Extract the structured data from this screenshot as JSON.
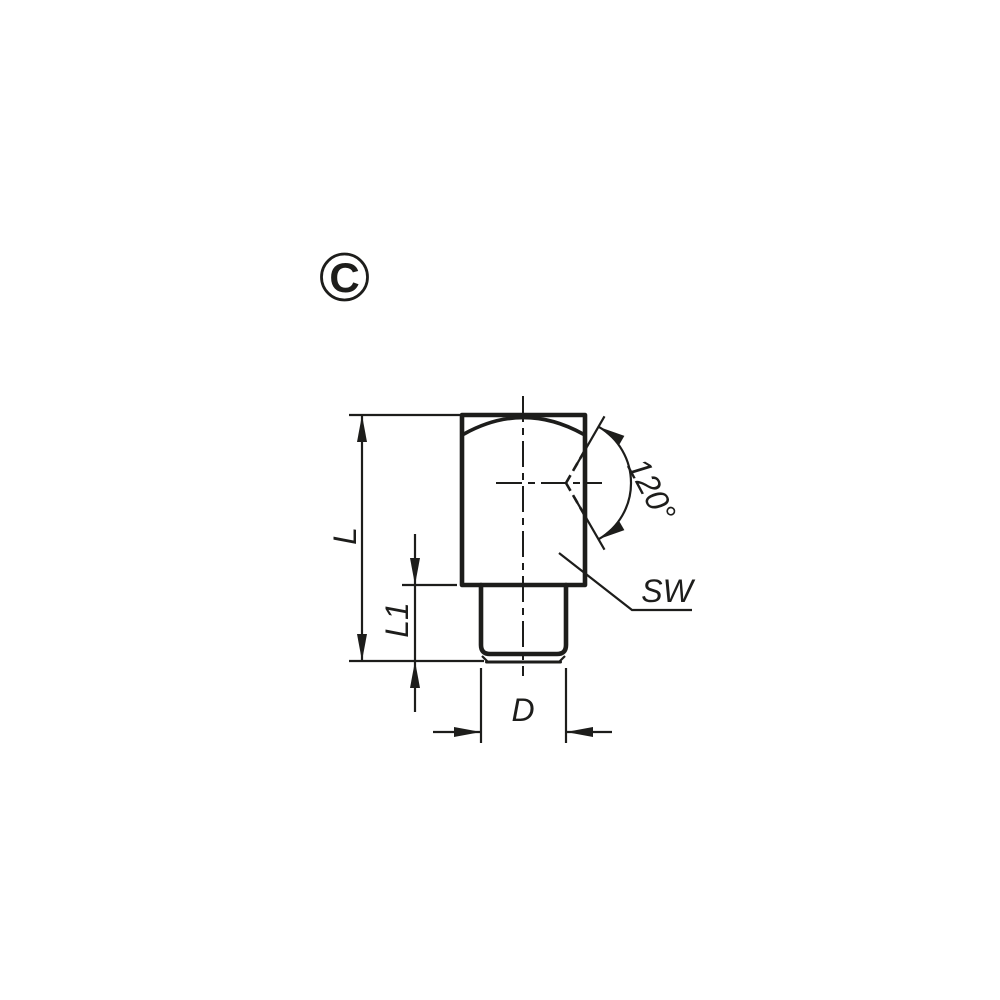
{
  "drawing": {
    "view_label": "C",
    "colors": {
      "line": "#1d1d1b",
      "background": "#ffffff"
    },
    "dimensions": {
      "overall_length": "L",
      "thread_length": "L1",
      "thread_diameter": "D",
      "wrench_size": "SW",
      "seat_angle": "120°"
    }
  }
}
